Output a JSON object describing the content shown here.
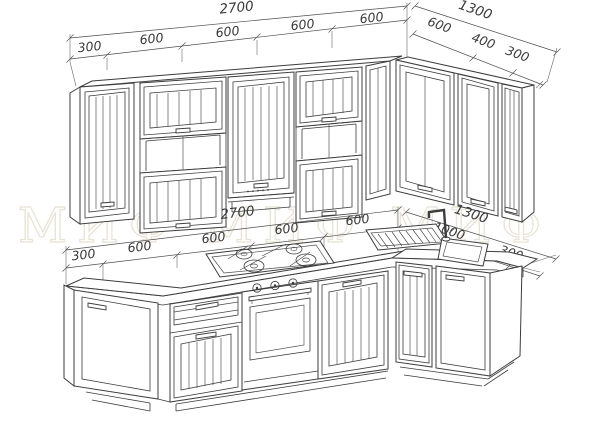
{
  "drawing": {
    "title": "kitchen set elevation drawing",
    "watermark": "МИФ  МИФ  МИФ",
    "colors": {
      "line": "#3c3c3c",
      "dimension_text": "#3a3a3a",
      "watermark": "#e9e3d6",
      "background": "#ffffff"
    }
  },
  "dimensions": {
    "upper_main": {
      "total": "2700",
      "segments": [
        "300",
        "600",
        "600",
        "600",
        "600"
      ]
    },
    "upper_return": {
      "total": "1300",
      "segments": [
        "600",
        "400",
        "300"
      ]
    },
    "lower_main": {
      "total": "2700",
      "segments": [
        "300",
        "600",
        "600",
        "600",
        "600"
      ]
    },
    "lower_return": {
      "total": "1300",
      "segments": [
        "1000",
        "300"
      ]
    }
  }
}
